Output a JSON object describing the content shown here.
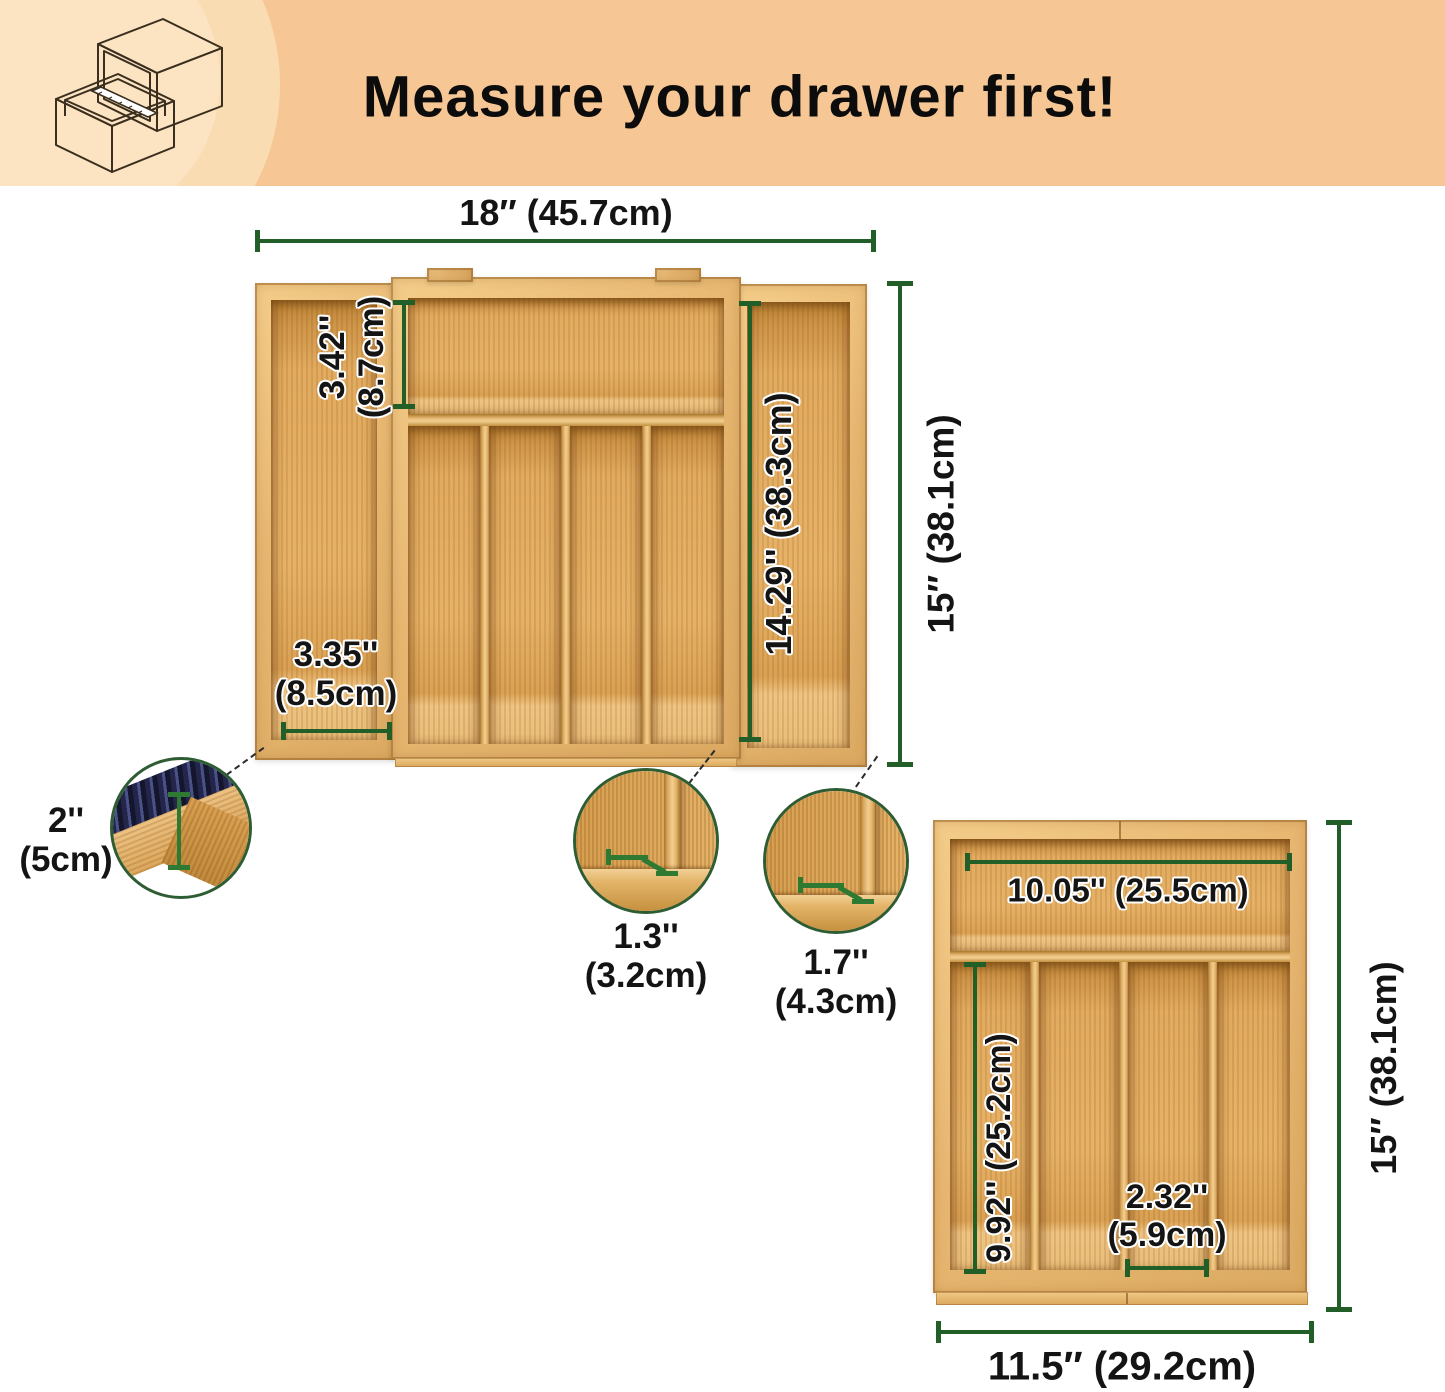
{
  "header": {
    "title": "Measure your drawer first!",
    "background_color": "#F6C795",
    "highlight_circle_color": "#FADCB2",
    "icon": "open-drawer-with-ruler-icon"
  },
  "annotation_color": "#215E28",
  "large_organizer": {
    "description": "expandable-bamboo-cutlery-tray",
    "top_width": "18″ (45.7cm)",
    "height": "15″ (38.1cm)",
    "top_compartment_height": {
      "inch": "3.42''",
      "cm": "(8.7cm)"
    },
    "side_compartment_length": "14.29''  (38.3cm)",
    "left_compartment_width": {
      "inch": "3.35''",
      "cm": "(8.5cm)"
    },
    "callouts": {
      "depth": {
        "inch": "2''",
        "cm": "(5cm)"
      },
      "slot_small": {
        "inch": "1.3''",
        "cm": "(3.2cm)"
      },
      "slot_large": {
        "inch": "1.7''",
        "cm": "(4.3cm)"
      }
    }
  },
  "small_organizer": {
    "description": "bamboo-cutlery-tray",
    "top_compartment_width": "10.05''  (25.5cm)",
    "column_length": "9.92''  (25.2cm)",
    "column_width": {
      "inch": "2.32''",
      "cm": "(5.9cm)"
    },
    "height": "15″ (38.1cm)",
    "bottom_width": "11.5″ (29.2cm)"
  }
}
